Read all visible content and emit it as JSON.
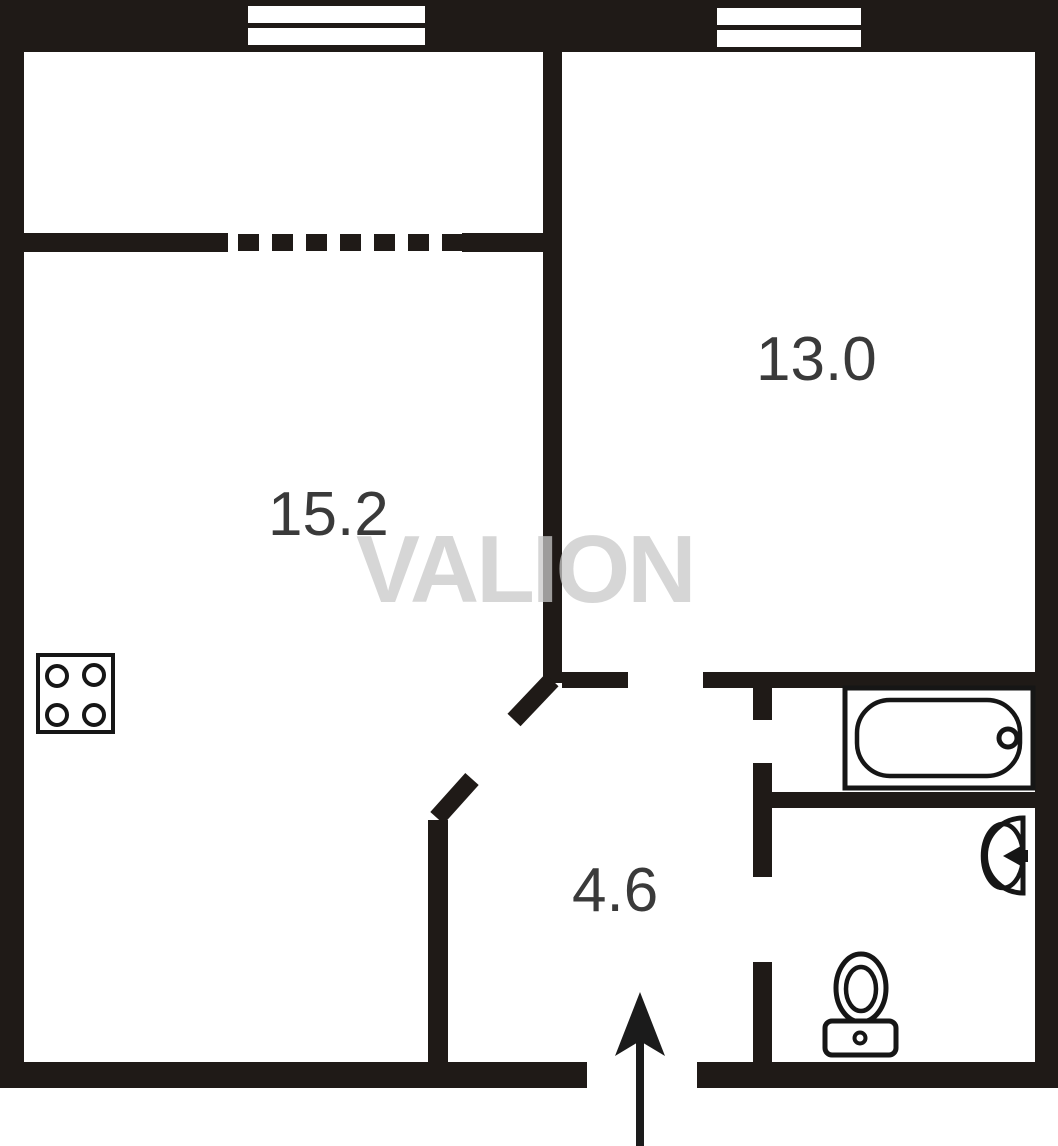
{
  "floor_plan": {
    "watermark": "VALION",
    "rooms": [
      {
        "id": "living-room",
        "area_label": "15.2"
      },
      {
        "id": "bedroom",
        "area_label": "13.0"
      },
      {
        "id": "hallway",
        "area_label": "4.6"
      }
    ],
    "fixtures": [
      {
        "icon": "stove-icon"
      },
      {
        "icon": "bathtub-icon"
      },
      {
        "icon": "sink-icon"
      },
      {
        "icon": "toilet-icon"
      },
      {
        "icon": "entrance-arrow-icon"
      },
      {
        "icon": "window-icon"
      },
      {
        "icon": "window-icon"
      }
    ],
    "colors": {
      "wall": "#1f1a17",
      "label_text": "#3a3a3a",
      "watermark": "#cccccc",
      "background": "#ffffff"
    }
  }
}
